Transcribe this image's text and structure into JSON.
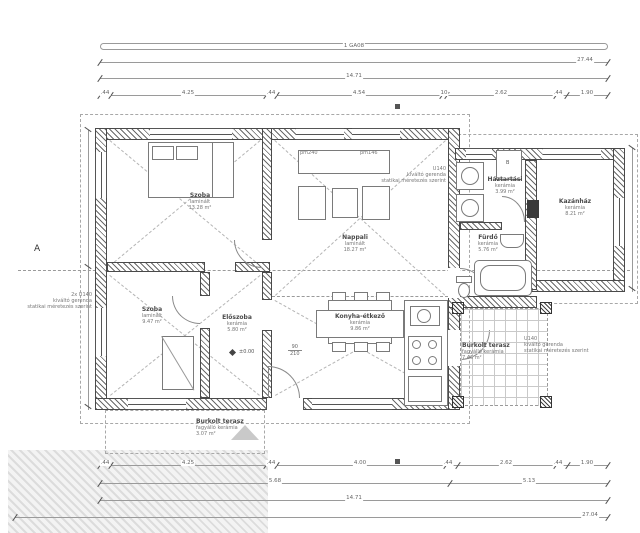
{
  "dims": {
    "beam_label": "1 GA08",
    "top_total": "27.44",
    "top_mid": "14.71",
    "top_chain": [
      ".44",
      "4.25",
      ".44",
      "4.54",
      "10",
      "2.62",
      ".44",
      "1.90"
    ],
    "bottom_chain": [
      ".44",
      "4.25",
      ".44",
      "4.00",
      ".44",
      "2.62",
      ".44",
      "1.90"
    ],
    "bottom_sub_left": "5.68",
    "bottom_sub_right": "5.13",
    "bottom_mid": "14.71",
    "bottom_total": "27.04"
  },
  "rooms": {
    "szoba1": {
      "name": "Szoba",
      "floor": "laminált",
      "area": "13.28 m²"
    },
    "nappali": {
      "name": "Nappali",
      "floor": "laminált",
      "area": "18.27 m²"
    },
    "haztartasi": {
      "name": "Háztartási",
      "floor": "kerámia",
      "area": "3.99 m²"
    },
    "kazanhaz": {
      "name": "Kazánház",
      "floor": "kerámia",
      "area": "8.21 m²"
    },
    "furdo": {
      "name": "Fürdő",
      "floor": "kerámia",
      "area": "5.76 m²"
    },
    "szoba2": {
      "name": "Szoba",
      "floor": "laminált",
      "area": "9.47 m²"
    },
    "eloszoba": {
      "name": "Előszoba",
      "floor": "kerámia",
      "area": "5.80 m²"
    },
    "konyha": {
      "name": "Konyha-étkező",
      "floor": "kerámia",
      "area": "9.86 m²"
    },
    "terasz_jobb": {
      "name": "Burkolt terasz",
      "floor": "fagyálló kerámia",
      "area": "7.46 m²"
    },
    "terasz_also": {
      "name": "Burkolt terasz",
      "floor": "fagyálló kerámia",
      "area": "3.07 m²"
    }
  },
  "annotations": {
    "left": {
      "l1": "2x U140",
      "l2": "kiváltó gerenda",
      "l3": "statikai méretezés szerint"
    },
    "mid": {
      "l1": "U140",
      "l2": "kiváltó gerenda",
      "l3": "statikai méretezés szerint"
    },
    "terasz": {
      "l1": "U140",
      "l2": "kiváltó gerenda",
      "l3": "statikai méretezés szerint"
    }
  },
  "markers": {
    "section": "A",
    "level": "±0.00",
    "door_w": "90",
    "door_h": "210",
    "pm_left": "pm240",
    "pm_right": "pm146",
    "boiler": "B"
  },
  "colors": {
    "line": "#9a9a9a",
    "wall_hatch": "#4a4a4a",
    "ground": "#e0e0e0"
  }
}
